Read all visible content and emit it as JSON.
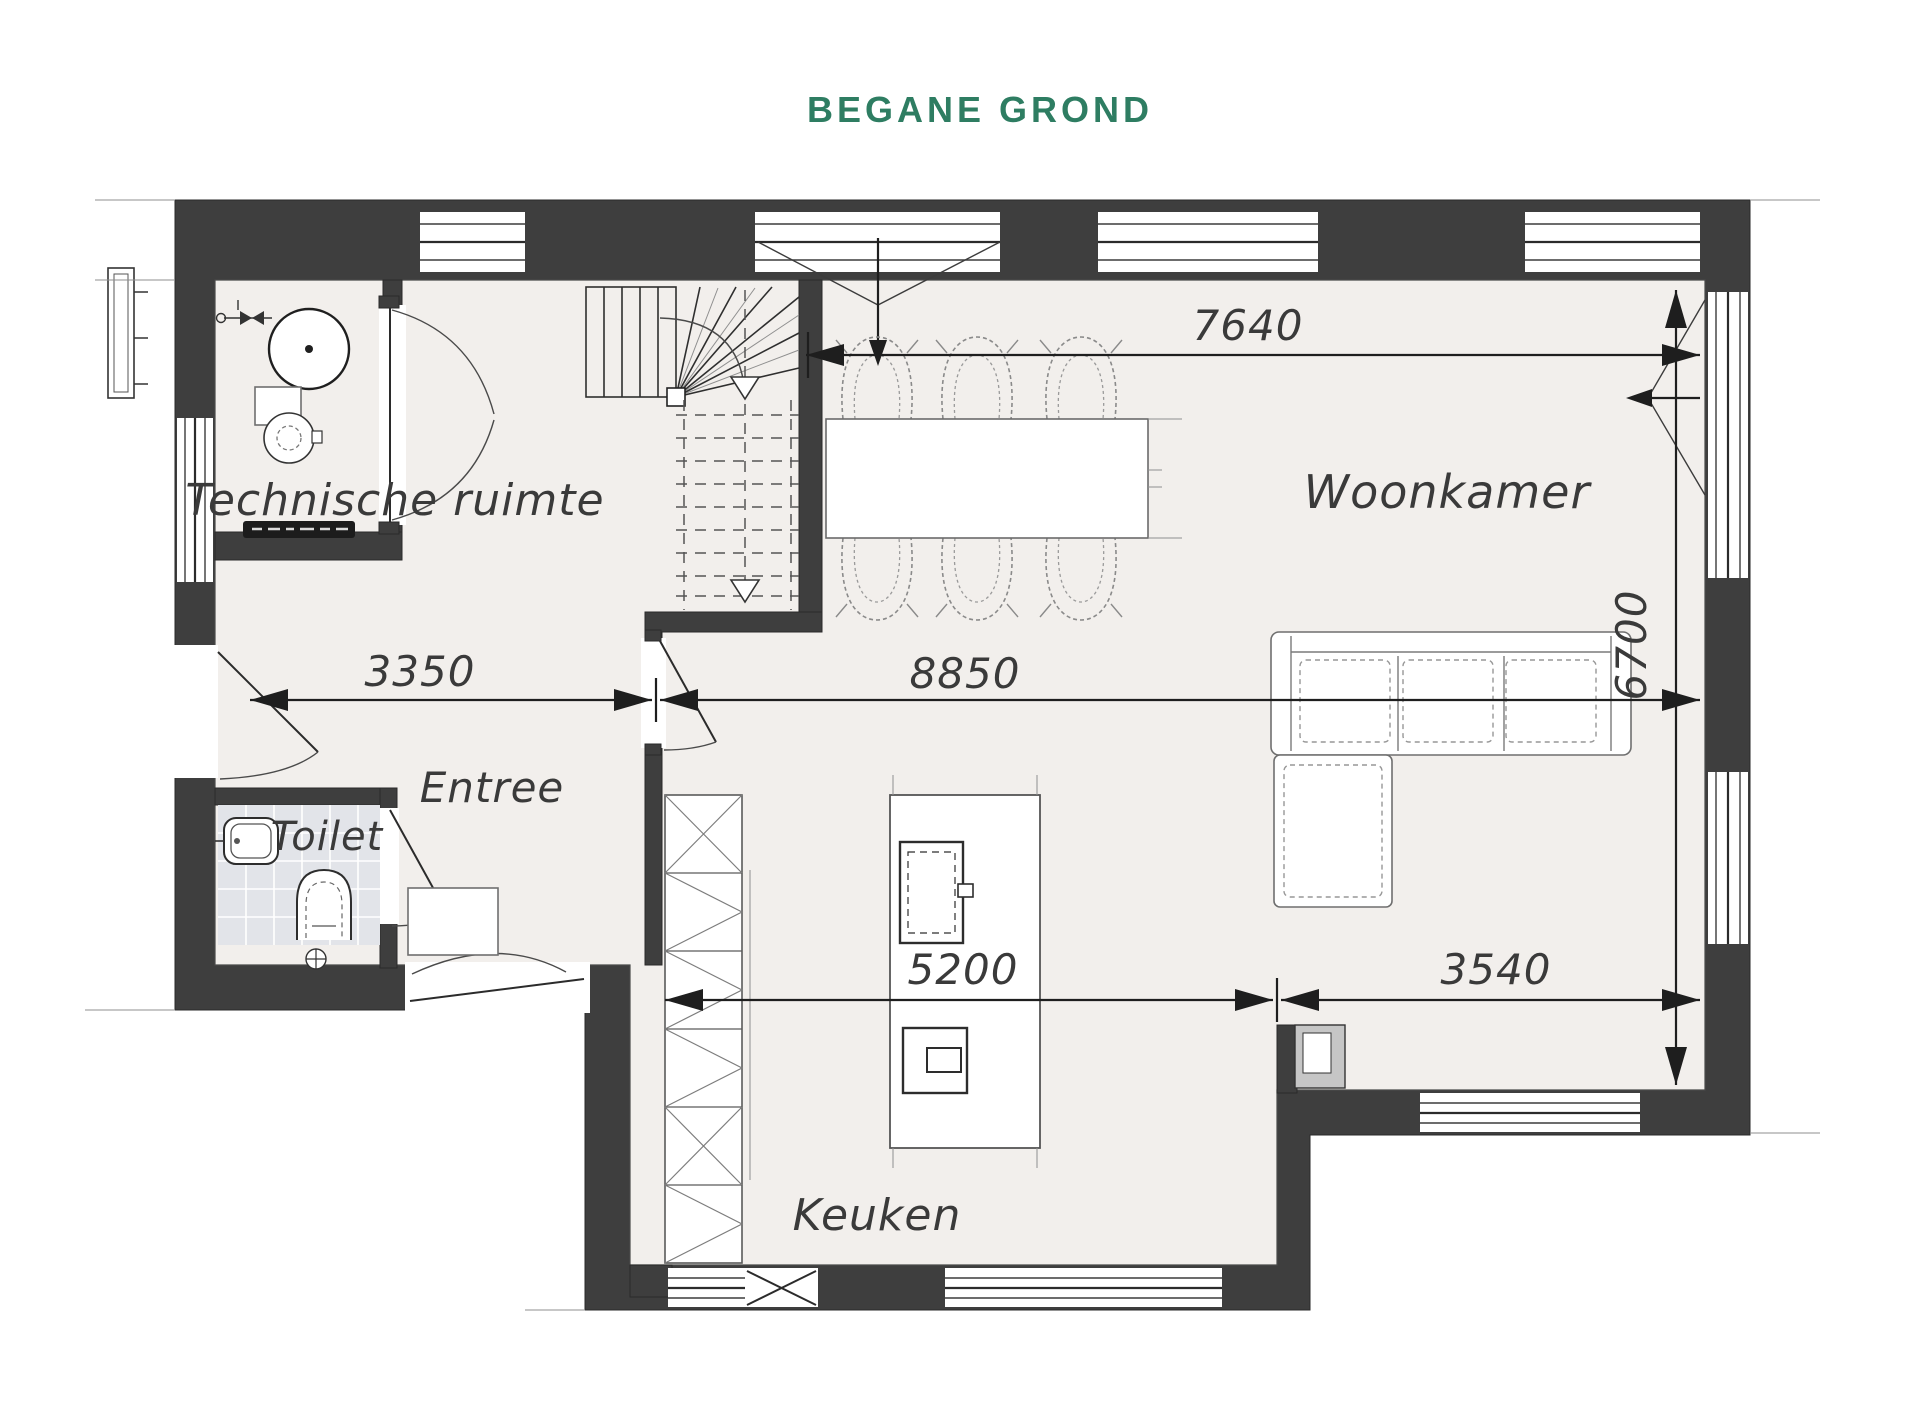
{
  "title": {
    "text": "BEGANE GROND"
  },
  "colors": {
    "title": "#2E7D62",
    "wall": "#3E3E3E",
    "floor": "#F2EFEC",
    "toilet_tile": "#E2E4E9",
    "chimney_gray": "#C6C6C6",
    "ink": "#3A3A3A"
  },
  "rooms": {
    "technische_ruimte": {
      "label": "Technische ruimte"
    },
    "woonkamer": {
      "label": "Woonkamer"
    },
    "entree": {
      "label": "Entree"
    },
    "toilet": {
      "label": "Toilet"
    },
    "keuken": {
      "label": "Keuken"
    }
  },
  "dimensions": {
    "living_width_top": {
      "value": "7640",
      "orientation": "horizontal"
    },
    "entree_width": {
      "value": "3350",
      "orientation": "horizontal"
    },
    "living_width": {
      "value": "8850",
      "orientation": "horizontal"
    },
    "living_depth": {
      "value": "6700",
      "orientation": "vertical"
    },
    "kitchen_width": {
      "value": "5200",
      "orientation": "horizontal"
    },
    "terrace_width": {
      "value": "3540",
      "orientation": "horizontal"
    }
  }
}
